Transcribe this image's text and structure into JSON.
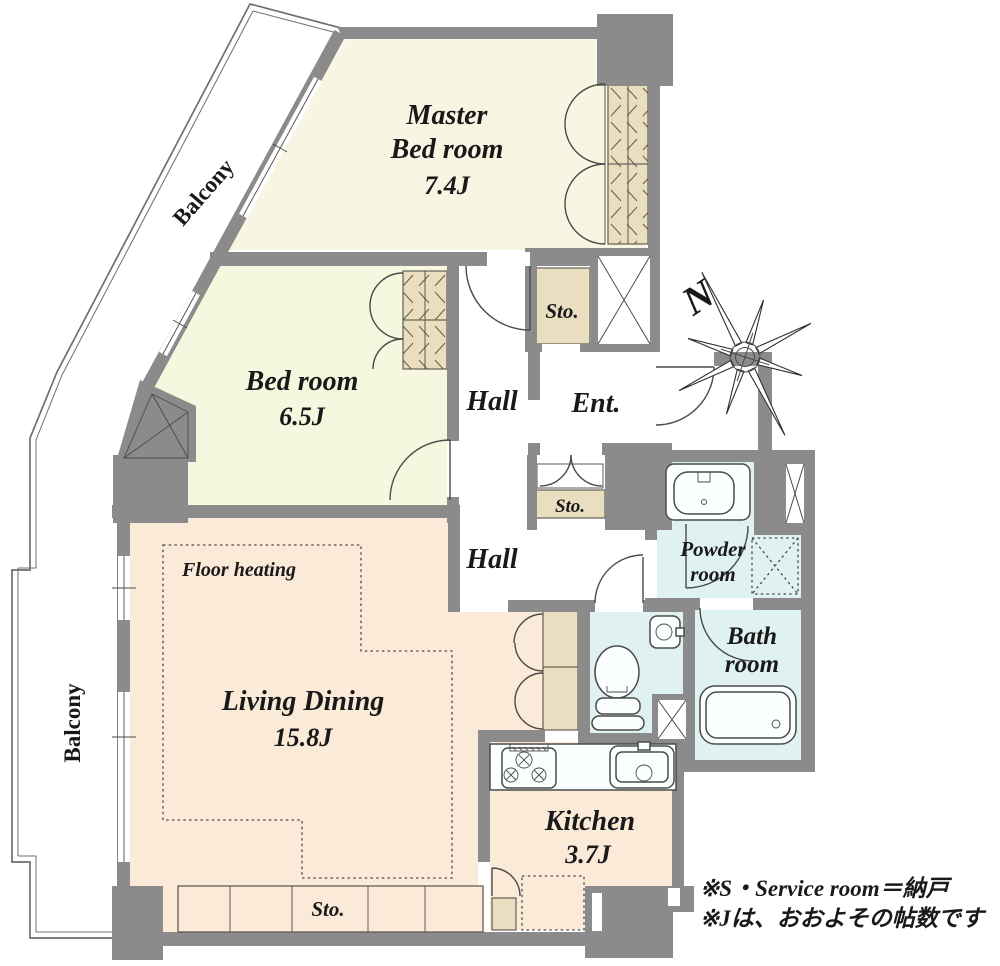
{
  "floor_plan": {
    "colors": {
      "wall": "#8b8b8b",
      "master": "#f8f5e2",
      "bedroom": "#f5f7df",
      "living": "#fcead9",
      "wet": "#e0f1f1",
      "storage": "#e9dfc0"
    },
    "balcony_top": {
      "label": "Balcony"
    },
    "balcony_left": {
      "label": "Balcony"
    },
    "master_bedroom": {
      "name_line1": "Master",
      "name_line2": "Bed room",
      "size": "7.4J"
    },
    "bedroom": {
      "name": "Bed room",
      "size": "6.5J"
    },
    "hall_upper": {
      "label": "Hall"
    },
    "hall_lower": {
      "label": "Hall"
    },
    "entrance": {
      "label": "Ent."
    },
    "storage_upper": {
      "label": "Sto."
    },
    "storage_middle": {
      "label": "Sto."
    },
    "storage_bottom": {
      "label": "Sto."
    },
    "powder_room": {
      "name_line1": "Powder",
      "name_line2": "room"
    },
    "bath_room": {
      "name_line1": "Bath",
      "name_line2": "room"
    },
    "living_dining": {
      "name": "Living Dining",
      "size": "15.8J"
    },
    "floor_heating": {
      "label": "Floor heating"
    },
    "kitchen": {
      "name": "Kitchen",
      "size": "3.7J"
    },
    "compass": {
      "label": "N"
    },
    "notes": {
      "line1": "※S・Service room＝納戸",
      "line2": "※Jは、おおよその帖数です"
    }
  }
}
